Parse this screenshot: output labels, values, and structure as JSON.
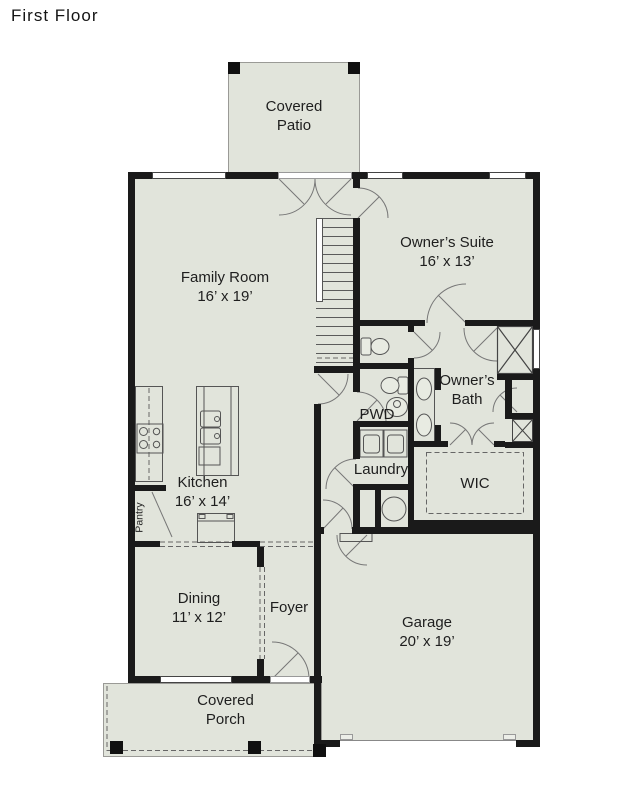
{
  "title": "First Floor",
  "colors": {
    "floor_fill": "#e1e4db",
    "wall": "#1a1a1a",
    "line": "#777777",
    "background": "#ffffff"
  },
  "rooms": {
    "covered_patio": [
      "Covered",
      "Patio"
    ],
    "family_room": [
      "Family Room",
      "16’ x 19’"
    ],
    "owners_suite": [
      "Owner’s Suite",
      "16’ x 13’"
    ],
    "owners_bath": [
      "Owner’s",
      "Bath"
    ],
    "pwd": [
      "PWD"
    ],
    "laundry": [
      "Laundry"
    ],
    "wic": [
      "WIC"
    ],
    "kitchen": [
      "Kitchen",
      "16’ x 14’"
    ],
    "pantry": [
      "Pantry"
    ],
    "dining": [
      "Dining",
      "11’ x 12’"
    ],
    "foyer": [
      "Foyer"
    ],
    "garage": [
      "Garage",
      "20’ x 19’"
    ],
    "covered_porch": [
      "Covered",
      "Porch"
    ]
  }
}
